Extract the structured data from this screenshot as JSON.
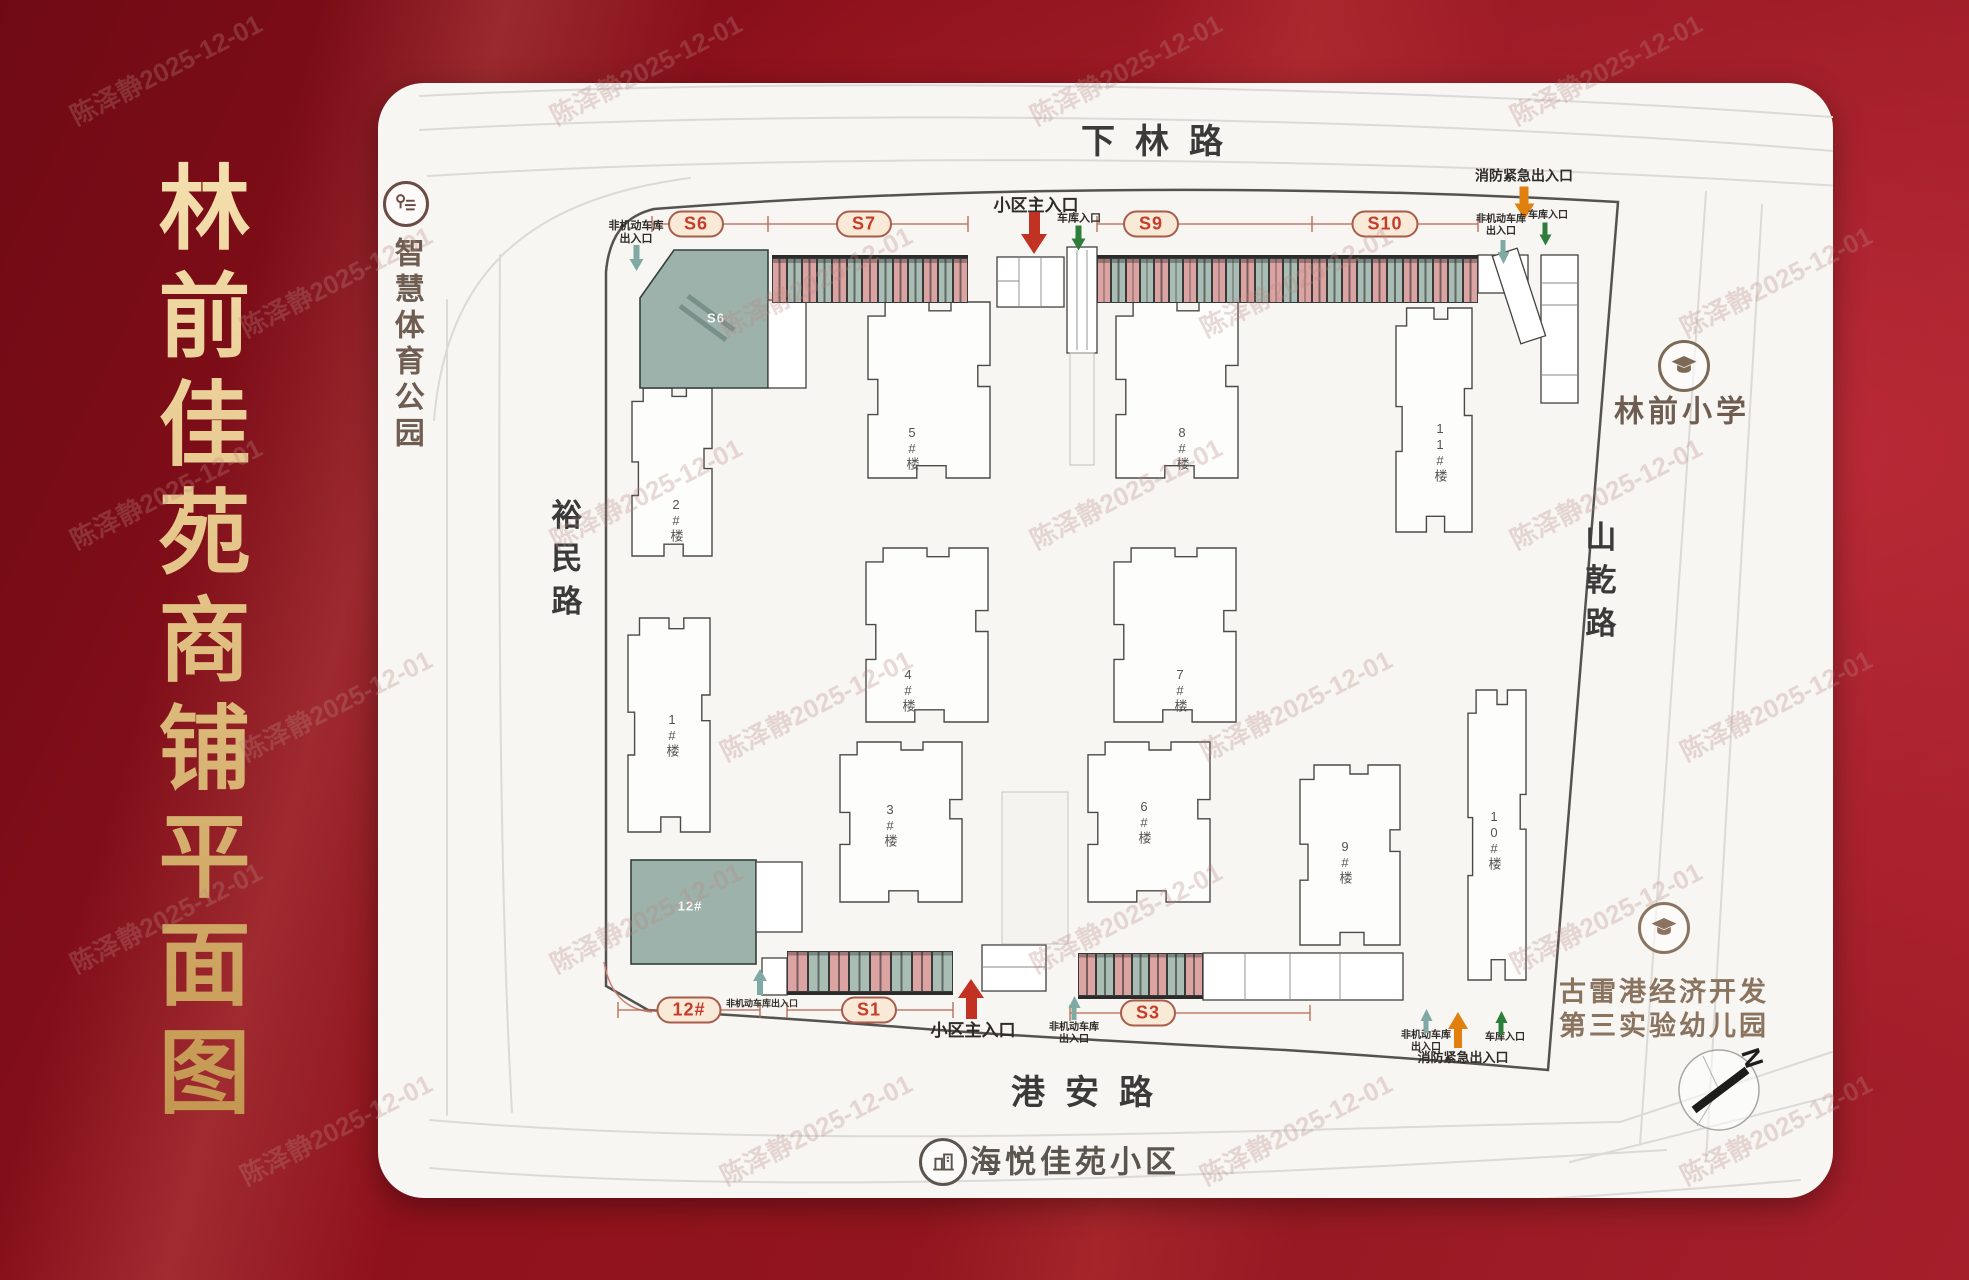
{
  "title": "林前佳苑商铺平面图",
  "watermark": "陈泽静2025-12-01",
  "roads": {
    "top": "下林路",
    "bottom": "港安路",
    "left": "裕民路",
    "right": "山乾路"
  },
  "landmarks": {
    "park": "智慧体育公园",
    "school": "林前小学",
    "kindergarten_line1": "古雷港经济开发",
    "kindergarten_line2": "第三实验幼儿园",
    "community": "海悦佳苑小区"
  },
  "compass_label": "N",
  "block_labels": {
    "s6": "S6",
    "b12": "12#"
  },
  "colors": {
    "background_red": "#8e111c",
    "gold": "#e3c285",
    "panel": "#f7f6f3",
    "shop_pink": "#dba4a2",
    "shop_green": "#a9bdb4",
    "anchor_green": "#9cb2ab",
    "pill_bg": "#f9ead8",
    "pill_text": "#c63b2a",
    "arrow_red": "#c23222",
    "arrow_green": "#2f7d3b",
    "arrow_teal": "#7fa9a3",
    "arrow_orange": "#e2800f"
  },
  "pills": [
    {
      "label": "S6",
      "x": 696,
      "y": 224
    },
    {
      "label": "S7",
      "x": 864,
      "y": 224
    },
    {
      "label": "S9",
      "x": 1151,
      "y": 224
    },
    {
      "label": "S10",
      "x": 1385,
      "y": 224
    },
    {
      "label": "12#",
      "x": 689,
      "y": 1010
    },
    {
      "label": "S1",
      "x": 869,
      "y": 1010
    },
    {
      "label": "S3",
      "x": 1148,
      "y": 1013
    }
  ],
  "entrances": [
    {
      "label": "非机动车库\n出入口",
      "x": 636,
      "y": 233,
      "fs": 11,
      "arrow": {
        "x": 636,
        "y": 258,
        "w": 15,
        "h": 26,
        "dir": "down",
        "c": "#7fa9a3"
      }
    },
    {
      "label": "小区主入口",
      "x": 1036,
      "y": 206,
      "fs": 17,
      "arrow": {
        "x": 1034,
        "y": 233,
        "w": 26,
        "h": 42,
        "dir": "down",
        "c": "#c23222"
      }
    },
    {
      "label": "车库入口",
      "x": 1079,
      "y": 219,
      "fs": 11,
      "arrow": {
        "x": 1078,
        "y": 238,
        "w": 15,
        "h": 25,
        "dir": "down",
        "c": "#2f7d3b"
      }
    },
    {
      "label": "消防紧急出入口",
      "x": 1524,
      "y": 176,
      "fs": 14,
      "arrow": {
        "x": 1524,
        "y": 203,
        "w": 21,
        "h": 33,
        "dir": "down",
        "c": "#e2800f"
      }
    },
    {
      "label": "非机动车库\n出入口",
      "x": 1501,
      "y": 226,
      "fs": 10,
      "arrow": {
        "x": 1503,
        "y": 252,
        "w": 13,
        "h": 24,
        "dir": "down",
        "c": "#7fa9a3"
      }
    },
    {
      "label": "车库入口",
      "x": 1548,
      "y": 216,
      "fs": 10,
      "arrow": {
        "x": 1545,
        "y": 234,
        "w": 13,
        "h": 23,
        "dir": "down",
        "c": "#2f7d3b"
      }
    },
    {
      "label": "非机动车库出入口",
      "x": 762,
      "y": 1004,
      "fs": 9,
      "arrow": {
        "x": 760,
        "y": 982,
        "w": 14,
        "h": 26,
        "dir": "up",
        "c": "#7fa9a3"
      }
    },
    {
      "label": "小区主入口",
      "x": 973,
      "y": 1031,
      "fs": 17,
      "arrow": {
        "x": 971,
        "y": 999,
        "w": 26,
        "h": 40,
        "dir": "up",
        "c": "#c23222"
      }
    },
    {
      "label": "非机动车库\n出入口",
      "x": 1074,
      "y": 1034,
      "fs": 10,
      "arrow": {
        "x": 1074,
        "y": 1008,
        "w": 13,
        "h": 24,
        "dir": "up",
        "c": "#7fa9a3"
      }
    },
    {
      "label": "非机动车库\n出入口",
      "x": 1426,
      "y": 1042,
      "fs": 10,
      "arrow": {
        "x": 1426,
        "y": 1021,
        "w": 13,
        "h": 24,
        "dir": "up",
        "c": "#7fa9a3"
      }
    },
    {
      "label": "消防紧急出入口",
      "x": 1463,
      "y": 1058,
      "fs": 13,
      "arrow": {
        "x": 1458,
        "y": 1030,
        "w": 20,
        "h": 36,
        "dir": "up",
        "c": "#e2800f"
      }
    },
    {
      "label": "车库入口",
      "x": 1505,
      "y": 1038,
      "fs": 10,
      "arrow": {
        "x": 1501,
        "y": 1023,
        "w": 13,
        "h": 24,
        "dir": "up",
        "c": "#2f7d3b"
      }
    }
  ],
  "buildings": [
    {
      "label": "2#楼",
      "x": 632,
      "y": 388,
      "w": 80,
      "h": 168,
      "lx": 676,
      "ly": 520
    },
    {
      "label": "1#楼",
      "x": 628,
      "y": 618,
      "w": 82,
      "h": 214,
      "lx": 672,
      "ly": 735
    },
    {
      "label": "5#楼",
      "x": 868,
      "y": 302,
      "w": 122,
      "h": 176,
      "lx": 912,
      "ly": 448
    },
    {
      "label": "4#楼",
      "x": 866,
      "y": 548,
      "w": 122,
      "h": 174,
      "lx": 908,
      "ly": 690
    },
    {
      "label": "3#楼",
      "x": 840,
      "y": 742,
      "w": 122,
      "h": 160,
      "lx": 890,
      "ly": 825
    },
    {
      "label": "8#楼",
      "x": 1116,
      "y": 302,
      "w": 122,
      "h": 176,
      "lx": 1182,
      "ly": 448
    },
    {
      "label": "7#楼",
      "x": 1114,
      "y": 548,
      "w": 122,
      "h": 174,
      "lx": 1180,
      "ly": 690
    },
    {
      "label": "6#楼",
      "x": 1088,
      "y": 742,
      "w": 122,
      "h": 160,
      "lx": 1144,
      "ly": 822
    },
    {
      "label": "11#楼",
      "x": 1396,
      "y": 308,
      "w": 76,
      "h": 224,
      "lx": 1440,
      "ly": 452
    },
    {
      "label": "9#楼",
      "x": 1300,
      "y": 765,
      "w": 100,
      "h": 180,
      "lx": 1345,
      "ly": 862
    },
    {
      "label": "10#楼",
      "x": 1468,
      "y": 690,
      "w": 58,
      "h": 290,
      "lx": 1494,
      "ly": 840
    }
  ],
  "strips": [
    {
      "x": 772,
      "y": 255,
      "w": 196,
      "h": 48,
      "n": 13,
      "side": "top"
    },
    {
      "x": 1097,
      "y": 255,
      "w": 215,
      "h": 48,
      "n": 15,
      "side": "top"
    },
    {
      "x": 1312,
      "y": 255,
      "w": 166,
      "h": 48,
      "n": 11,
      "side": "top"
    },
    {
      "x": 787,
      "y": 951,
      "w": 166,
      "h": 44,
      "n": 8,
      "side": "bottom"
    },
    {
      "x": 1078,
      "y": 953,
      "w": 125,
      "h": 46,
      "n": 7,
      "side": "bottom"
    }
  ]
}
